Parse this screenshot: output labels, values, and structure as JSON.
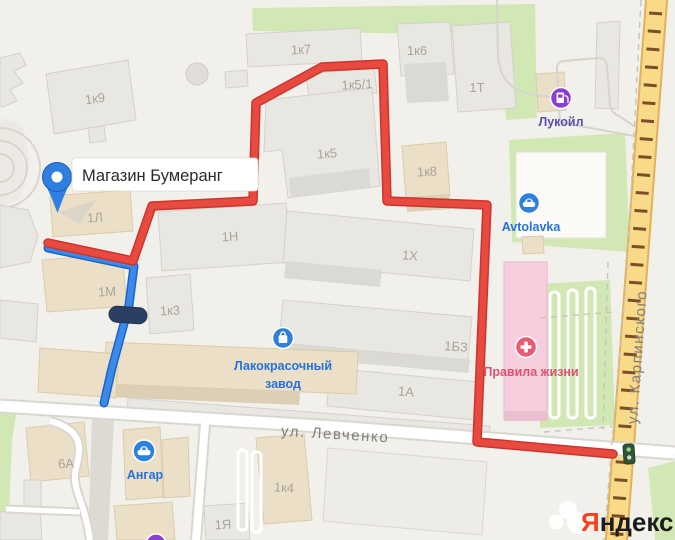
{
  "map": {
    "pin": {
      "label": "Магазин Бумеранг",
      "icon": "map-pin-icon"
    },
    "building_labels": [
      {
        "text": "1к9"
      },
      {
        "text": "1к7"
      },
      {
        "text": "1к6"
      },
      {
        "text": "1к5/1"
      },
      {
        "text": "1Т"
      },
      {
        "text": "1к5"
      },
      {
        "text": "1к8"
      },
      {
        "text": "1Л"
      },
      {
        "text": "1Н"
      },
      {
        "text": "1Х"
      },
      {
        "text": "1М"
      },
      {
        "text": "1к3"
      },
      {
        "text": "1БЗ"
      },
      {
        "text": "1А"
      },
      {
        "text": "6А"
      },
      {
        "text": "1к4"
      },
      {
        "text": "1Я"
      }
    ],
    "streets": [
      {
        "name": "ул. Левченко"
      },
      {
        "name": "ул. Карпинского"
      }
    ],
    "pois": [
      {
        "name": "Лукойл",
        "icon": "fuel-icon"
      },
      {
        "name": "Avtolavka",
        "icon": "car-icon"
      },
      {
        "name": "Лакокрасочный завод",
        "line1": "Лакокрасочный",
        "line2": "завод",
        "icon": "shopping-bag-icon"
      },
      {
        "name": "Правила жизни",
        "icon": "medical-cross-icon"
      },
      {
        "name": "Ангар",
        "icon": "car-icon"
      }
    ],
    "markers": [
      {
        "name": "barrier-icon"
      },
      {
        "name": "railway-crossing-light-icon"
      }
    ],
    "logo": {
      "ya": "Я",
      "rest": "ндекс"
    }
  },
  "colors": {
    "route_red": "#e94a40",
    "route_blue": "#3b8aea",
    "poi_blue": "#2f80dc",
    "poi_purple": "#8a3fd1",
    "poi_pink": "#e85b72",
    "poi_text_blue": "#2573d9",
    "poi_text_purple": "#5b50ae",
    "poi_text_pink": "#e0506e",
    "pin_blue": "#2f7fe3",
    "road_yellow": "#f8da88",
    "green": "#d2e8b4",
    "logo_red": "#fc3f1d",
    "logo_black": "#1c1c1c"
  }
}
